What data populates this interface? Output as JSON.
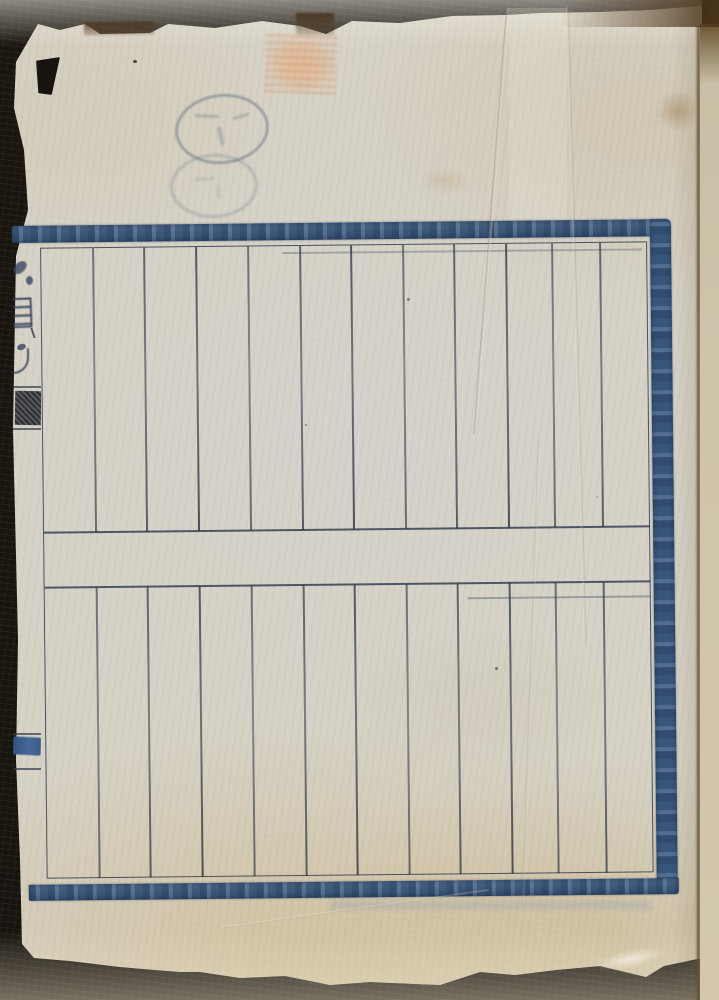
{
  "document": {
    "kind": "scanned folio: blank blue-ruled sheet of a traditional stitched book",
    "legible_text_present": false,
    "gutter_fragments_illegible": true
  },
  "palette": {
    "backdrop": "#17130e",
    "paper": "#d6d2c6",
    "paper_warm_edge": "#cfc2a4",
    "border_blue": "#3f5e85",
    "rule_line": "#323c4e",
    "stamp_orange": "#e7a774",
    "seal_blue_gray": "#56647a",
    "gutter_brown": "#60503a"
  },
  "grid": {
    "rows": 2,
    "columns_per_row": 12,
    "column_x_local": [
      80,
      131,
      183,
      235,
      287,
      338,
      390,
      441,
      493,
      539,
      587
    ],
    "upper_span": {
      "top": 9,
      "height": 284
    },
    "lower_span": {
      "top": 348,
      "height": 291
    }
  },
  "marks": {
    "rect_stamp_count": 1,
    "oval_seal_count": 2,
    "gutter_tab_block_count": 1
  }
}
